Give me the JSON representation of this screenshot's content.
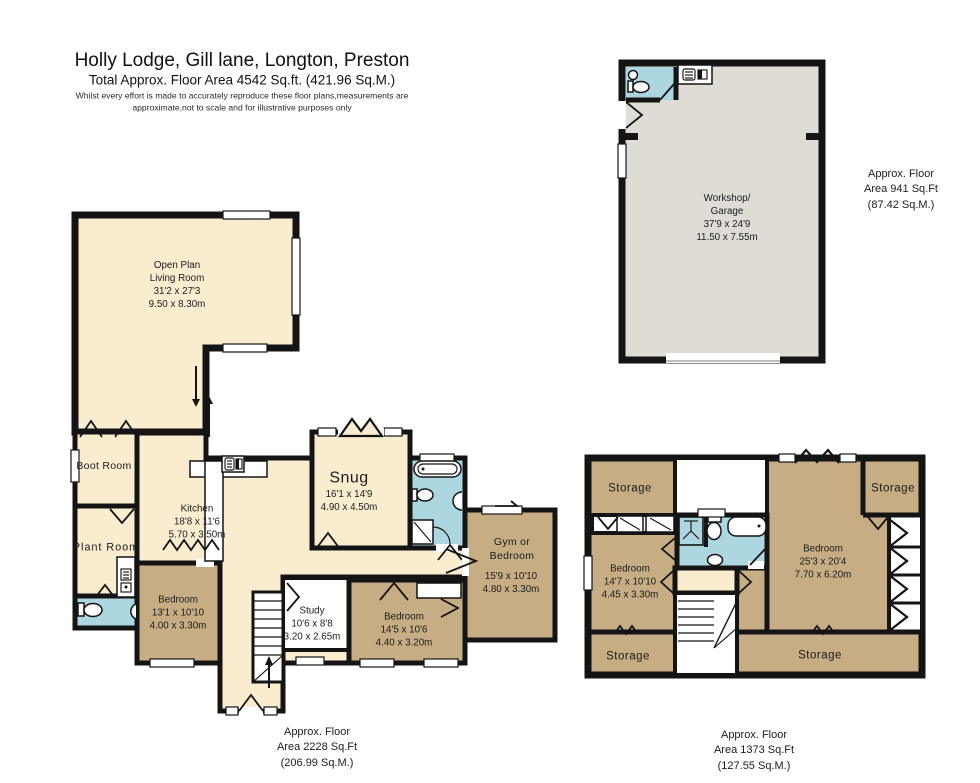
{
  "header": {
    "title": "Holly Lodge, Gill lane, Longton, Preston",
    "subtitle": "Total Approx. Floor Area 4542 Sq.ft. (421.96 Sq.M.)",
    "disclaimer": "Whilst every effort is made to accurately reproduce these floor plans,measurements are\napproximate,not to scale and for illustrative purposes only"
  },
  "colors": {
    "cream": "#FAECCE",
    "tan": "#C6AD83",
    "blue": "#ACD7E0",
    "gray": "#DFDCD6",
    "wall": "#141414"
  },
  "ground_floor": {
    "rooms": {
      "open_plan": "Open Plan\nLiving Room\n31'2 x 27'3\n9.50 x 8.30m",
      "boot_room": "Boot Room",
      "plant_room": "Plant Room",
      "kitchen": "Kitchen\n18'8 x 11'6\n5.70 x 3.50m",
      "snug_name": "Snug",
      "snug_dims": "16'1 x 14'9\n4.90 x 4.50m",
      "gym_name": "Gym or\nBedroom",
      "gym_dims": "15'9 x 10'10\n4.80 x 3.30m",
      "bedroom1": "Bedroom\n13'1 x 10'10\n4.00 x 3.30m",
      "study": "Study\n10'6 x 8'8\n3.20 x 2.65m",
      "bedroom2": "Bedroom\n14'5 x 10'6\n4.40 x 3.20m"
    },
    "area_note": "Approx. Floor\nArea 2228 Sq.Ft\n(206.99 Sq.M.)"
  },
  "first_floor": {
    "rooms": {
      "storage_tl": "Storage",
      "storage_tr": "Storage",
      "storage_bl": "Storage",
      "storage_br": "Storage",
      "bedroom_left": "Bedroom\n14'7 x 10'10\n4.45 x 3.30m",
      "bedroom_right": "Bedroom\n25'3 x 20'4\n7.70 x 6.20m"
    },
    "area_note": "Approx. Floor\nArea 1373 Sq.Ft\n(127.55 Sq.M.)"
  },
  "workshop_floor": {
    "rooms": {
      "workshop_garage": "Workshop/\nGarage\n37'9 x 24'9\n11.50 x 7.55m"
    },
    "area_note": "Approx. Floor\nArea 941 Sq.Ft\n(87.42 Sq.M.)"
  }
}
